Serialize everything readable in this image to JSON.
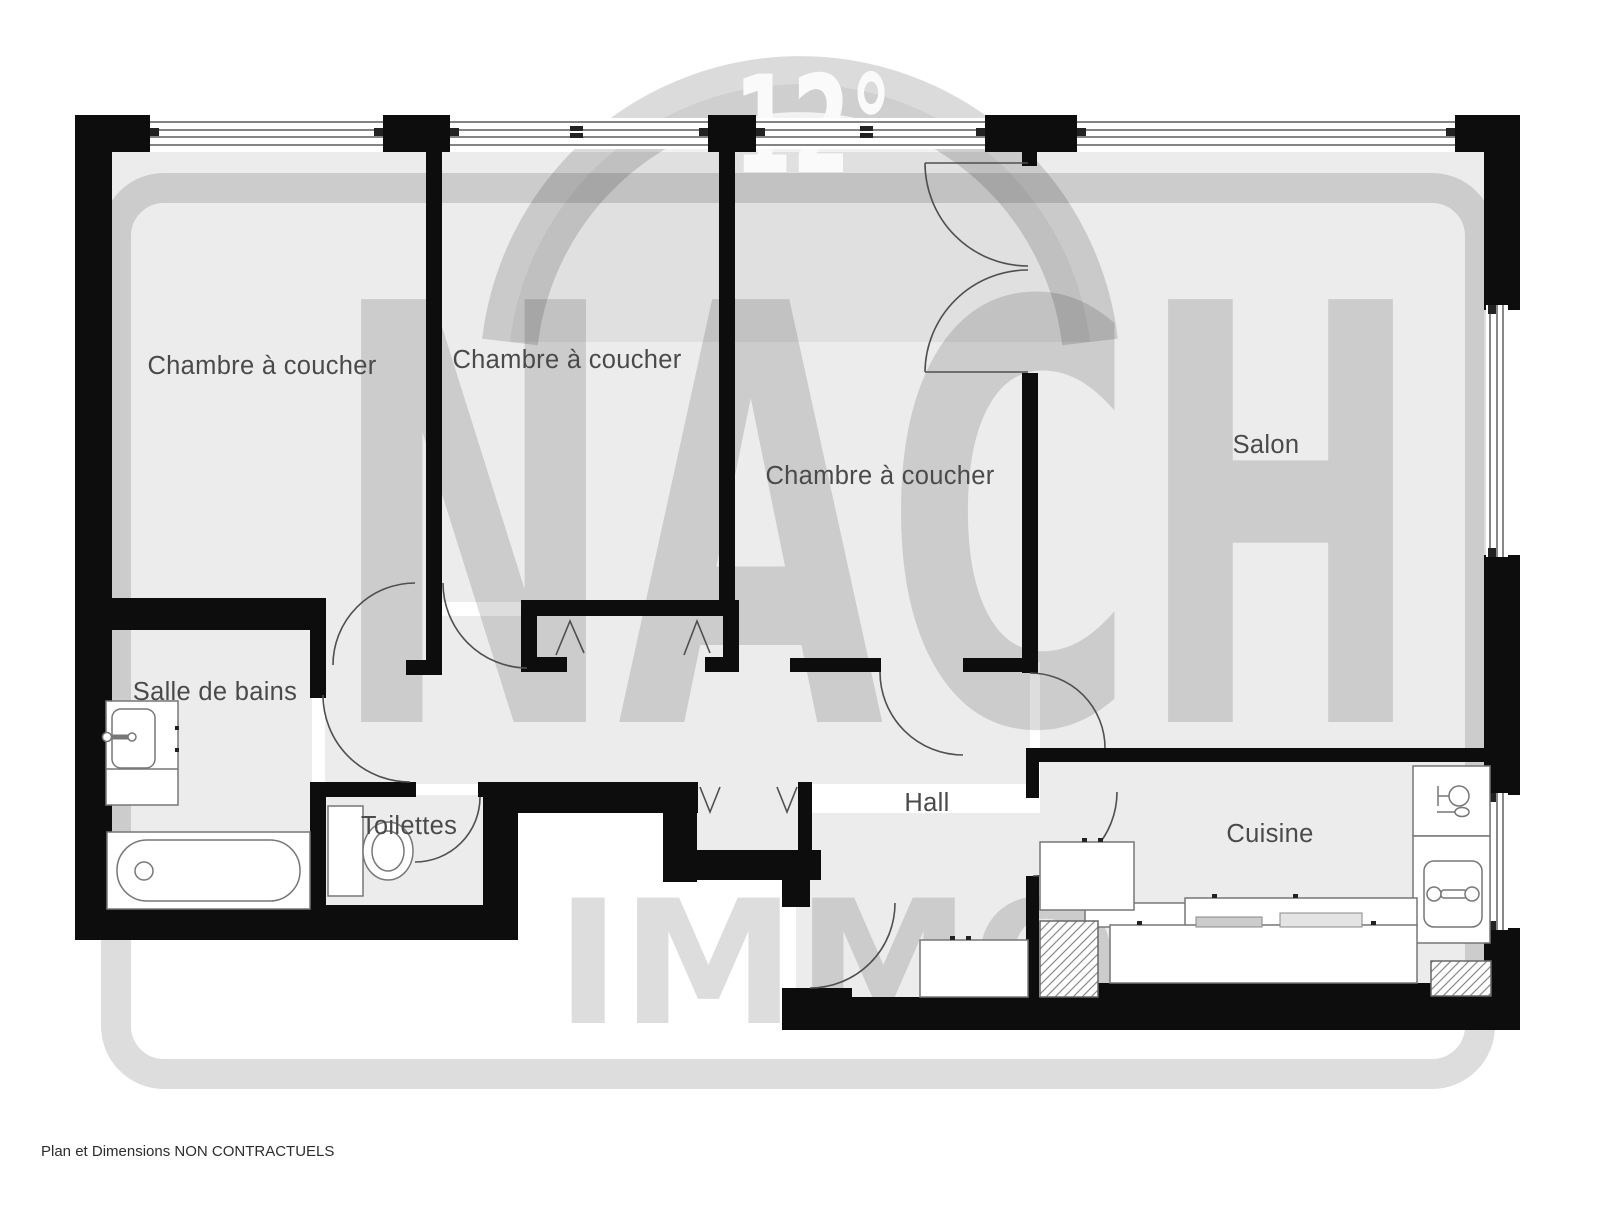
{
  "plan": {
    "room_labels": [
      {
        "id": "bedroom-1",
        "label": "Chambre à coucher"
      },
      {
        "id": "bedroom-2",
        "label": "Chambre à coucher"
      },
      {
        "id": "bedroom-3",
        "label": "Chambre à coucher"
      },
      {
        "id": "salon",
        "label": "Salon"
      },
      {
        "id": "bathroom",
        "label": "Salle de bains"
      },
      {
        "id": "toilets",
        "label": "Toilettes"
      },
      {
        "id": "hall",
        "label": "Hall"
      },
      {
        "id": "kitchen",
        "label": "Cuisine"
      }
    ],
    "fixture_icons": [
      "bathtub-icon",
      "washbasin-icon",
      "toilet-icon",
      "kitchen-sink-icon",
      "dishwasher-icon",
      "kitchen-counter",
      "wardrobe-cabinet",
      "ventilation-shaft",
      "door-arc",
      "window",
      "folding-door-marks"
    ]
  },
  "watermark": {
    "badge": "12°",
    "brand_line1": "NACH",
    "brand_line2": "IMMO"
  },
  "footer": {
    "disclaimer": "Plan et Dimensions NON CONTRACTUELS"
  },
  "colors": {
    "wall": "#0d0d0d",
    "room_fill": "#ececec",
    "watermark_tint": "rgba(0,0,0,0.135)",
    "label_text": "#4a4a4a",
    "badge_text": "#fafafa",
    "fixture_stroke": "#777777"
  }
}
